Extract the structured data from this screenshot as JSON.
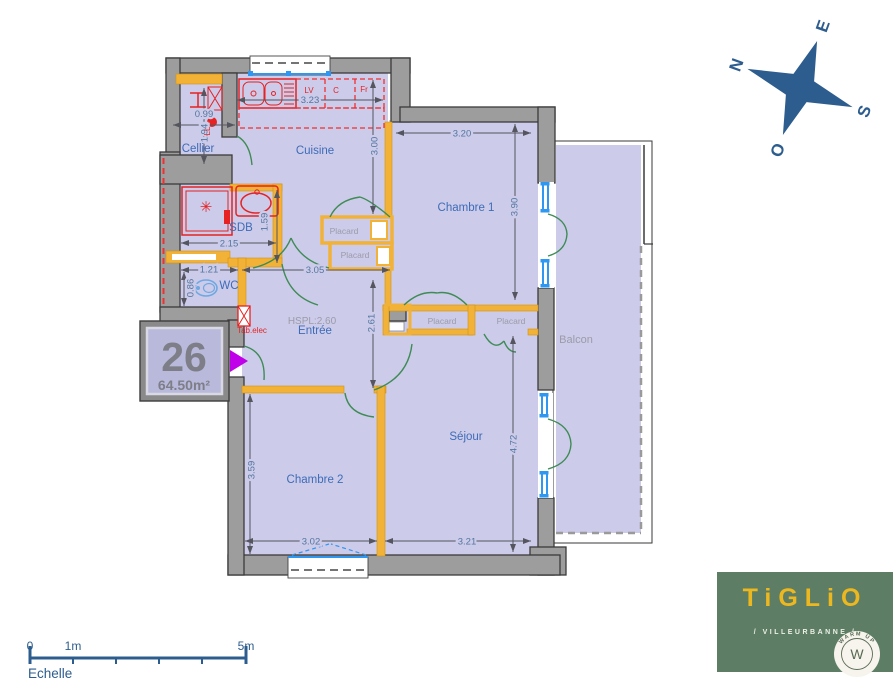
{
  "plan": {
    "rooms": {
      "cellier": "Cellier",
      "cuisine": "Cuisine",
      "chambre1": "Chambre 1",
      "sdb": "SDB",
      "wc": "WC",
      "entree": "Entrée",
      "sejour": "Séjour",
      "chambre2": "Chambre 2",
      "balcon": "Balcon",
      "placard": "Placard"
    },
    "notes": {
      "hspl": "HSPL:2.60"
    },
    "fixtures": {
      "lv": "LV",
      "c": "C",
      "fr": "Fr",
      "ll": "LL",
      "tab_elec": "Tab.elec"
    },
    "dimensions": {
      "cellier_w": "0.99",
      "cellier_h": "1.94",
      "cuisine_w": "3.23",
      "cuisine_h": "3.00",
      "chambre1_w": "3.20",
      "chambre1_h": "3.90",
      "sdb_w": "2.15",
      "sdb_h": "1.59",
      "wc_w": "1.21",
      "wc_h": "0.86",
      "entree_w": "3.05",
      "entree_h": "2.61",
      "chambre2_w": "3.02",
      "chambre2_h": "3.59",
      "sejour_w": "3.21",
      "sejour_h": "4.72"
    }
  },
  "badge": {
    "number": "26",
    "area": "64.50m²"
  },
  "compass": {
    "north": "N",
    "east": "E",
    "south": "S",
    "west": "O"
  },
  "scale_bar": {
    "start": "0",
    "first": "1m",
    "last": "5m",
    "label": "Echelle"
  },
  "logo": {
    "brand": "TiGLiO",
    "location": "/ VILLEURBANNE /",
    "seal_letter": "W",
    "seal_text": "WARM UP"
  },
  "colors": {
    "floor": "#cccbea",
    "wall": "#9d9d9d",
    "partition_yellow": "#f2b237",
    "fixture_red": "#e62222",
    "door_green": "#3f8b55",
    "window_blue": "#2e97f2",
    "room_label_blue": "#3e6cb7",
    "dim_text": "#54769e",
    "muted_label": "#9b9ba8",
    "compass_blue": "#2d5d8e",
    "logo_green": "#5d7e65",
    "logo_gold": "#edb71f",
    "entry_arrow": "#bf00e8",
    "badge_fill": "#b9b9dc"
  }
}
